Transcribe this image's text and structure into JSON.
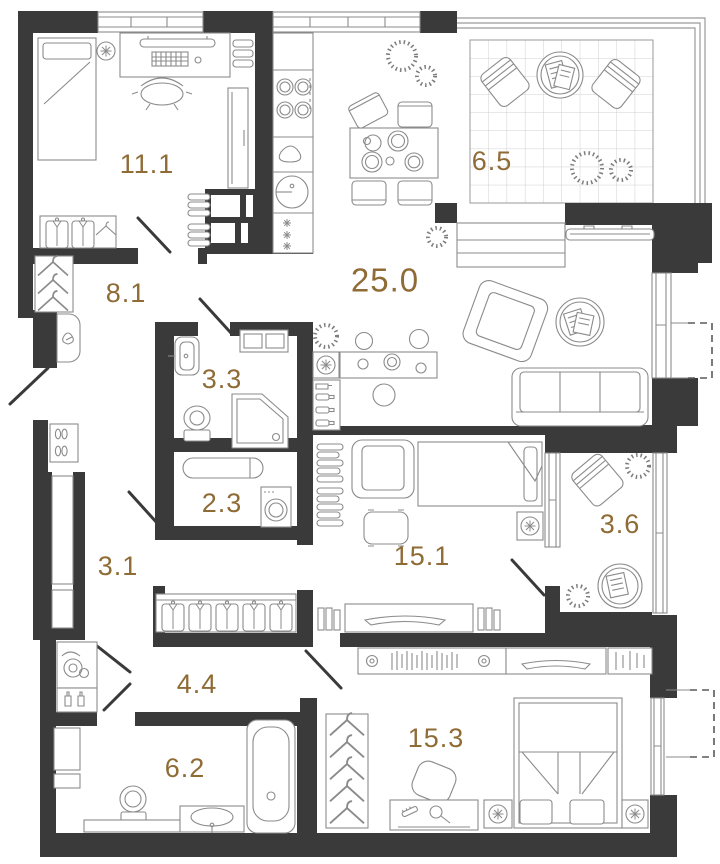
{
  "plan": {
    "title": "apartment-floor-plan",
    "colors": {
      "wall": "#3a3a3a",
      "furniture_line": "#8b8b8b",
      "label": "#8f6b35",
      "tile_grid": "#cfcfcf"
    },
    "rooms": [
      {
        "id": "bedroom-1",
        "area": "11.1"
      },
      {
        "id": "hallway",
        "area": "8.1"
      },
      {
        "id": "kitchen-living",
        "area": "25.0"
      },
      {
        "id": "terrace",
        "area": "6.5"
      },
      {
        "id": "bathroom-1",
        "area": "3.3"
      },
      {
        "id": "laundry",
        "area": "2.3"
      },
      {
        "id": "corridor-1",
        "area": "3.1"
      },
      {
        "id": "bedroom-2",
        "area": "15.1"
      },
      {
        "id": "balcony",
        "area": "3.6"
      },
      {
        "id": "corridor-2",
        "area": "4.4"
      },
      {
        "id": "bathroom-2",
        "area": "6.2"
      },
      {
        "id": "bedroom-3",
        "area": "15.3"
      }
    ]
  }
}
